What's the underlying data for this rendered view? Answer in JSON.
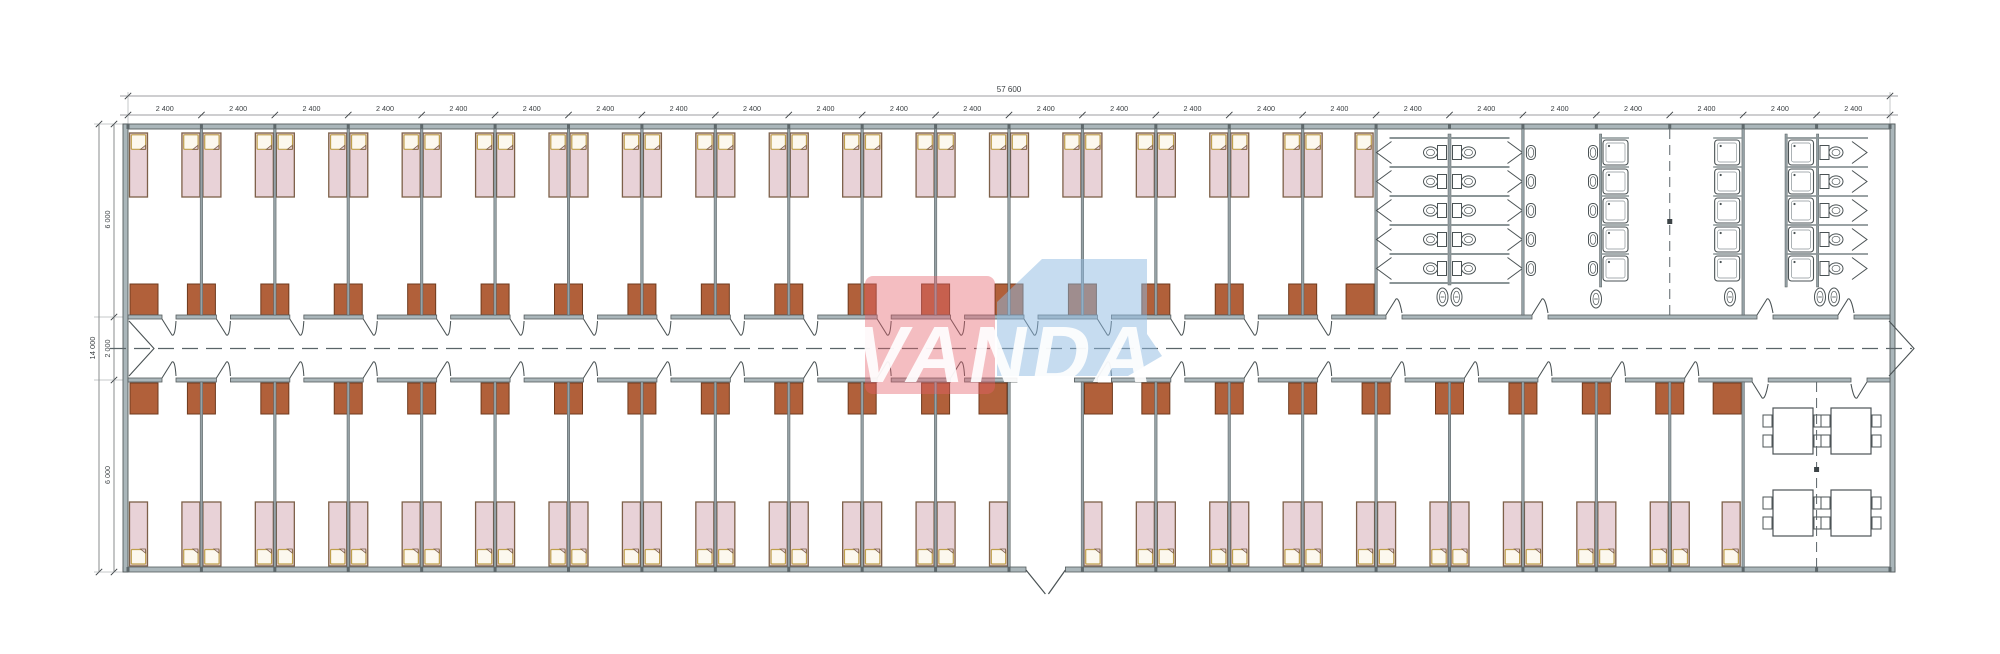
{
  "logo": {
    "text": "VANDA",
    "red_color": "#e4626c",
    "blue_color": "#8db9e2",
    "text_color": "#ffffff"
  },
  "dimensions": {
    "total_top_label": "57 600",
    "bay_label": "2 400",
    "bay_count": 24,
    "left_total_label": "14 000",
    "left_segment_labels": [
      "6 000",
      "2 000",
      "6 000"
    ]
  },
  "rooms": {
    "top_bedroom_bays": 17,
    "bottom_bedroom_bays": 21,
    "toilet_stall_rows": 5,
    "sink_count_per_column": 5,
    "shower_count_per_column": 5,
    "dining_tables": 4,
    "chairs_per_table": 4
  },
  "colors": {
    "line": "#44494c",
    "dim": "#3a3f42",
    "wall_fill": "#aab6ba",
    "wall_stroke": "#555c5e",
    "partition": "#96a2a6",
    "bed_fill": "#e8d2d7",
    "bed_stroke": "#7d6049",
    "pillow_fill": "#fcf8ee",
    "pillow_stroke": "#bfa04c",
    "wardrobe_fill": "#b1603a",
    "wardrobe_stroke": "#6e3a1d",
    "fixture_stroke": "#4a5254",
    "axis": "#5a6468",
    "tick": "#5e686b"
  },
  "geometry": {
    "canvas_w": 2000,
    "canvas_h": 654,
    "x0": 128,
    "x1": 1890,
    "y_top_out": 124,
    "y_top_in": 129,
    "y_cor1": 315,
    "y_cor2": 319,
    "y_cor3": 378,
    "y_cor4": 382,
    "y_bot_in": 567,
    "y_bot_out": 572,
    "bays": 24,
    "top_rooms": 17,
    "bottom_zone_bays": 22,
    "entrance_bay": 13,
    "center_y": 348.5,
    "dim_y_total": 96,
    "dim_y_bay": 115,
    "dim_x_total": 99,
    "dim_x_seg": 114,
    "bed_w": 18,
    "bed_h": 64,
    "wardrobe_w": 28,
    "wardrobe_h": 31,
    "row_y0": 138,
    "row_h": 29,
    "row_n": 5
  }
}
